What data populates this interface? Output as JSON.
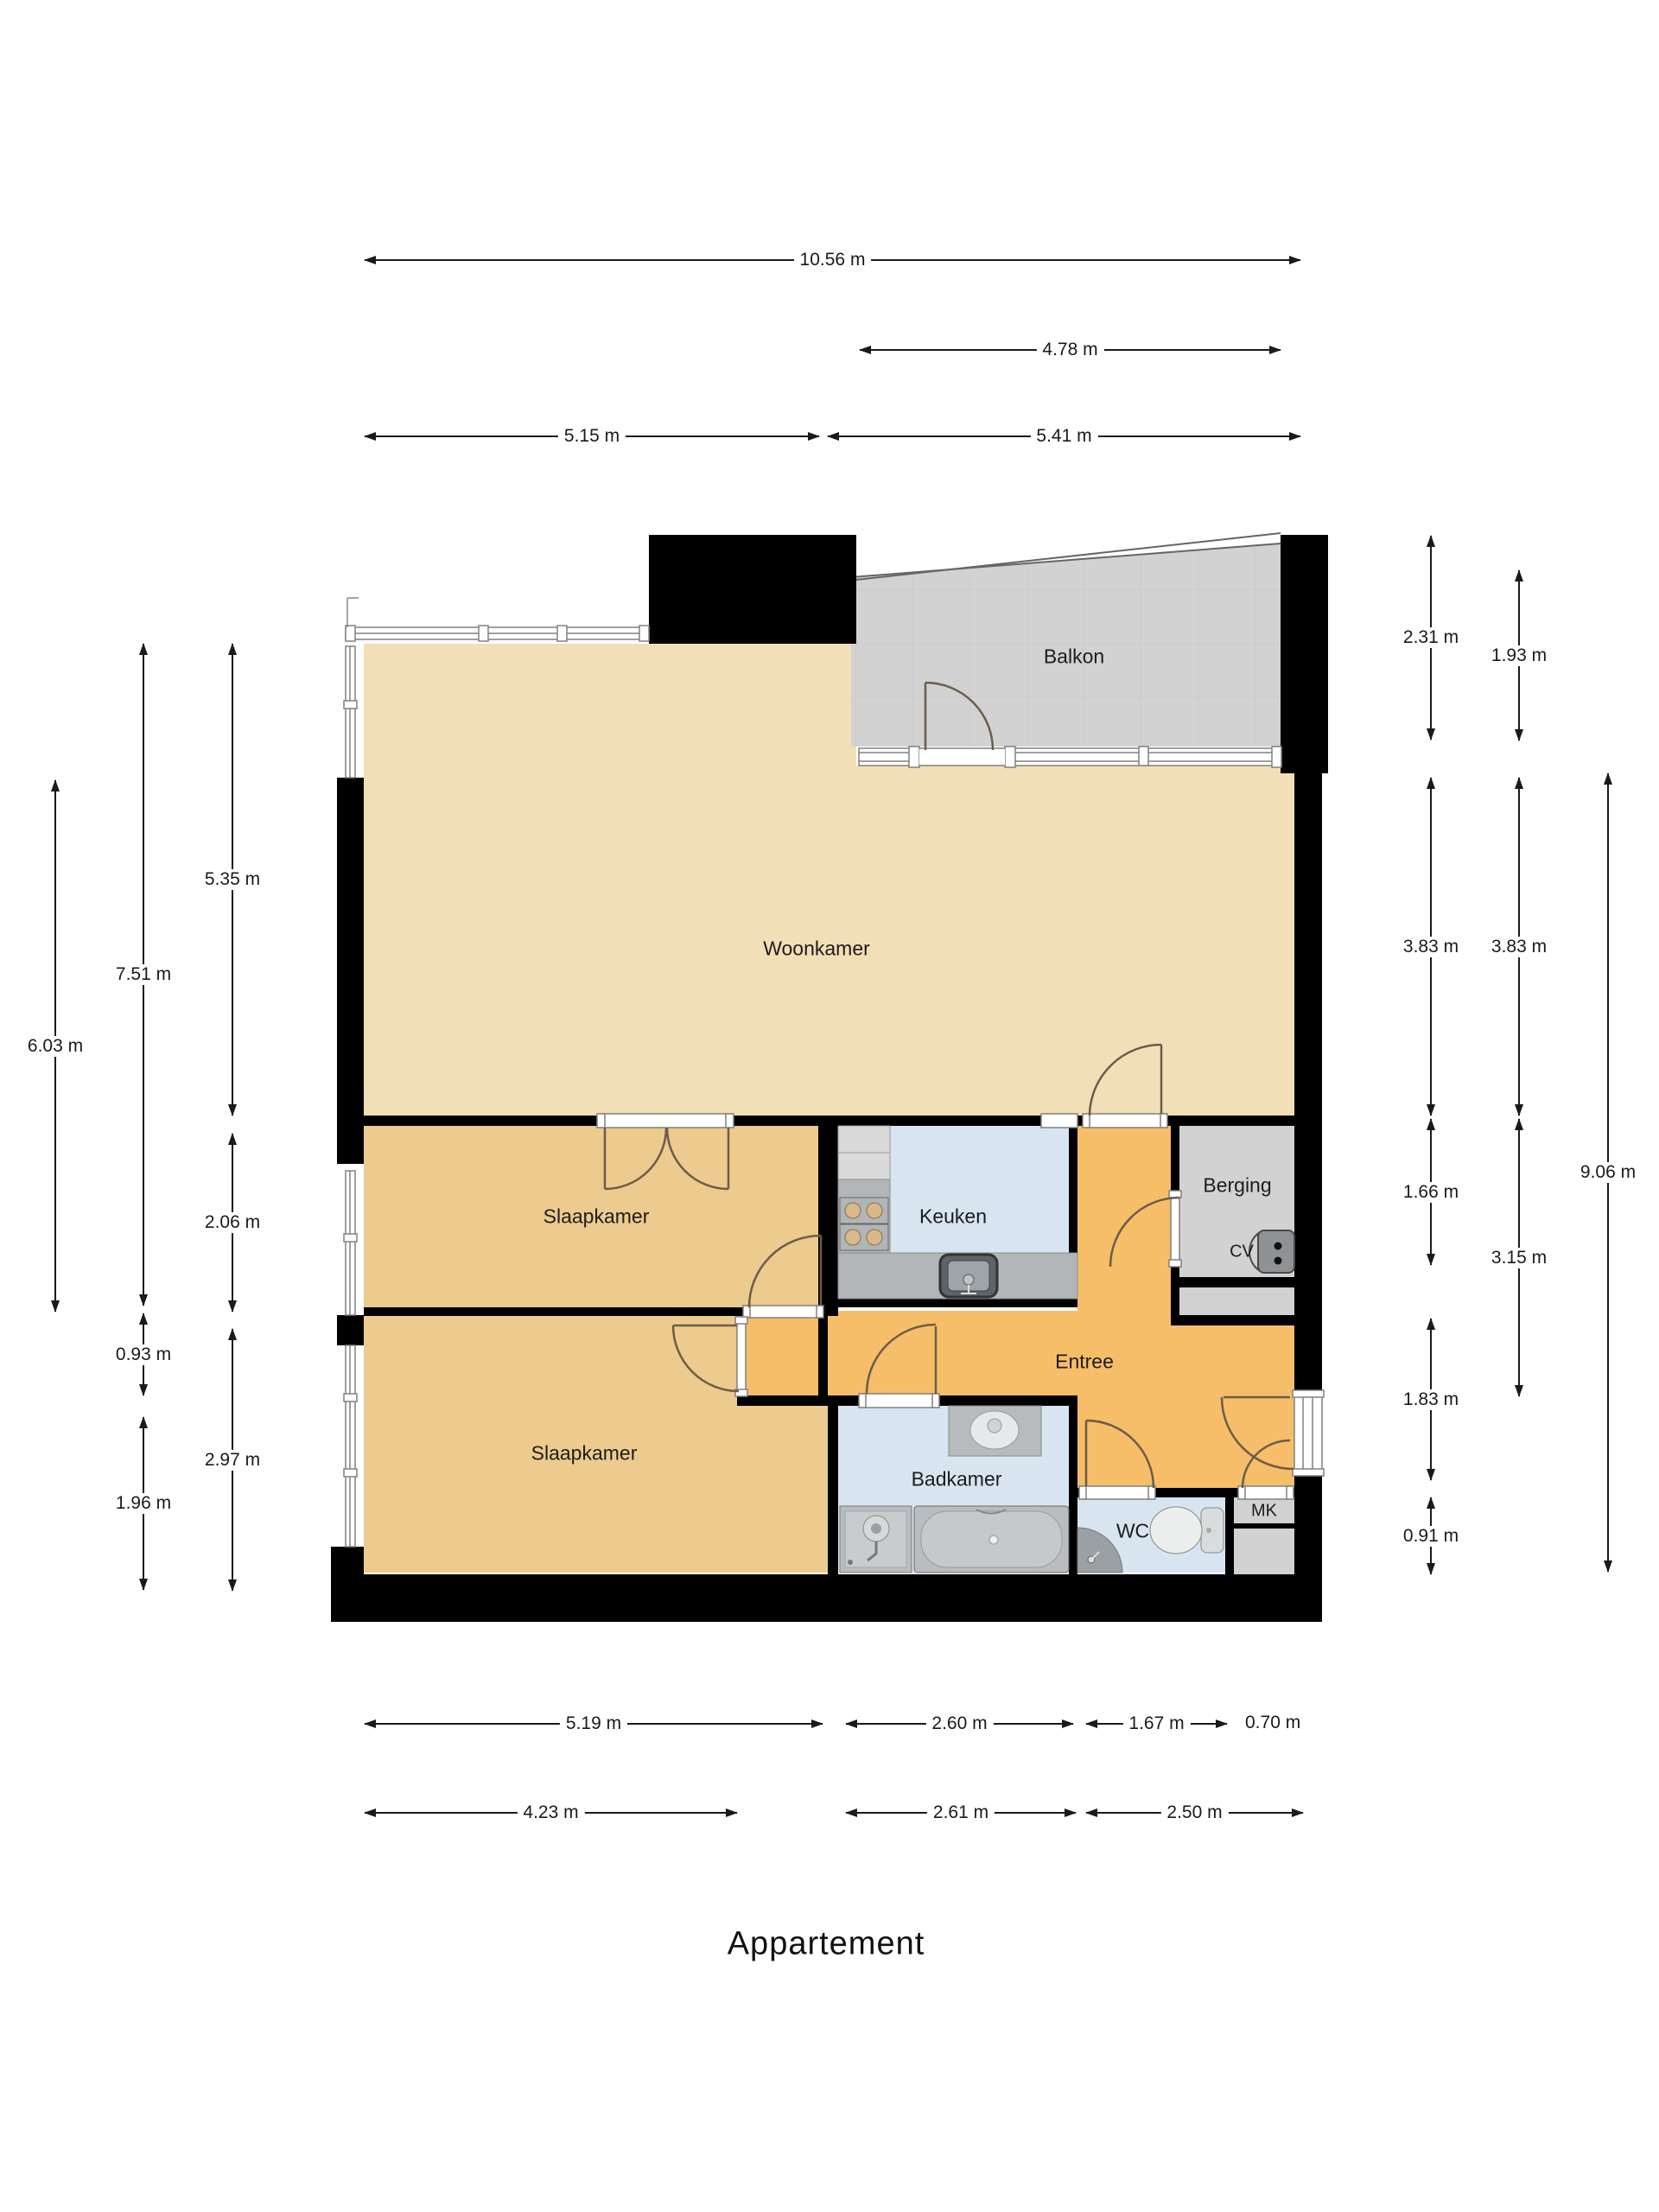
{
  "title": "Appartement",
  "rooms": {
    "balkon": {
      "label": "Balkon"
    },
    "woonkamer": {
      "label": "Woonkamer"
    },
    "slaapkamer1": {
      "label": "Slaapkamer"
    },
    "slaapkamer2": {
      "label": "Slaapkamer"
    },
    "keuken": {
      "label": "Keuken"
    },
    "berging": {
      "label": "Berging"
    },
    "cv": {
      "label": "CV"
    },
    "entree": {
      "label": "Entree"
    },
    "badkamer": {
      "label": "Badkamer"
    },
    "wc": {
      "label": "WC"
    },
    "mk": {
      "label": "MK"
    }
  },
  "dimensions": {
    "top": [
      {
        "label": "10.56 m"
      },
      {
        "label": "4.78 m"
      },
      {
        "label": "5.15 m"
      },
      {
        "label": "5.41 m"
      }
    ],
    "left": [
      {
        "label": "6.03 m"
      },
      {
        "label": "7.51 m"
      },
      {
        "label": "5.35 m"
      },
      {
        "label": "2.06 m"
      },
      {
        "label": "0.93 m"
      },
      {
        "label": "2.97 m"
      },
      {
        "label": "1.96 m"
      }
    ],
    "right": [
      {
        "label": "2.31 m"
      },
      {
        "label": "1.93 m"
      },
      {
        "label": "3.83 m"
      },
      {
        "label": "3.83 m"
      },
      {
        "label": "1.66 m"
      },
      {
        "label": "3.15 m"
      },
      {
        "label": "9.06 m"
      },
      {
        "label": "1.83 m"
      },
      {
        "label": "0.91 m"
      }
    ],
    "bottom": [
      {
        "label": "5.19 m"
      },
      {
        "label": "2.60 m"
      },
      {
        "label": "1.67 m"
      },
      {
        "label": "0.70 m"
      },
      {
        "label": "4.23 m"
      },
      {
        "label": "2.61 m"
      },
      {
        "label": "2.50 m"
      }
    ]
  },
  "colors": {
    "wall": "#000000",
    "woonkamer": "#F3DFB7",
    "slaapkamer": "#EDCA8E",
    "entree": "#F6BE69",
    "wet_room": "#D9E4F1",
    "gray_room": "#D2D2D2",
    "counter": "#B3B6B9",
    "dimension": "#1a1a1a"
  }
}
